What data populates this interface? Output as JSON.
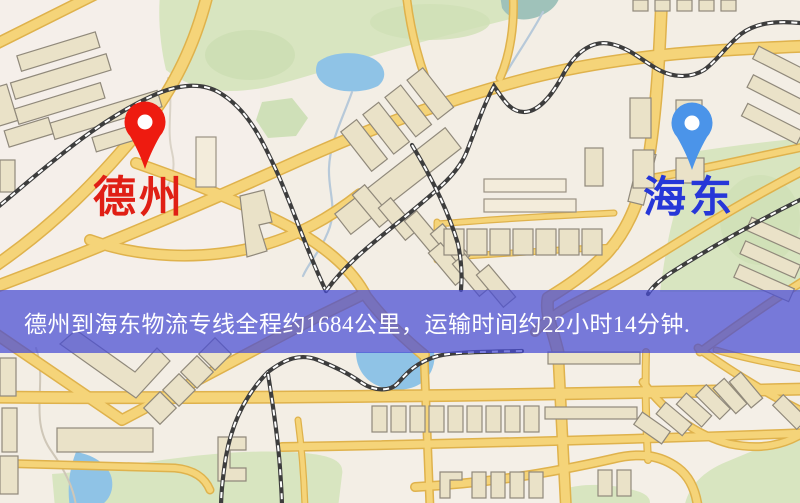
{
  "banner": {
    "text": "德州到海东物流专线全程约1684公里，运输时间约22小时14分钟.",
    "background_color": "#494dd5",
    "text_color": "#ffffff"
  },
  "origin_marker": {
    "label": "德州",
    "pin_color": "#ee1b10",
    "label_color": "#e01f15"
  },
  "destination_marker": {
    "label": "海东",
    "pin_color": "#4b94e9",
    "label_color": "#2637d8"
  },
  "route_info": {
    "origin": "德州",
    "destination": "海东",
    "service": "物流专线",
    "distance": "约1684公里",
    "transport_time": "约22小时14分钟"
  },
  "map_palette": {
    "background": "#f3eee5",
    "road_fill": "#f5d479",
    "road_casing": "#dfb24c",
    "building_fill": "#eae2c8",
    "park_green": "#d8e5c0",
    "water_blue": "#8fc3e6",
    "railway_dark": "#3d3d3d"
  }
}
